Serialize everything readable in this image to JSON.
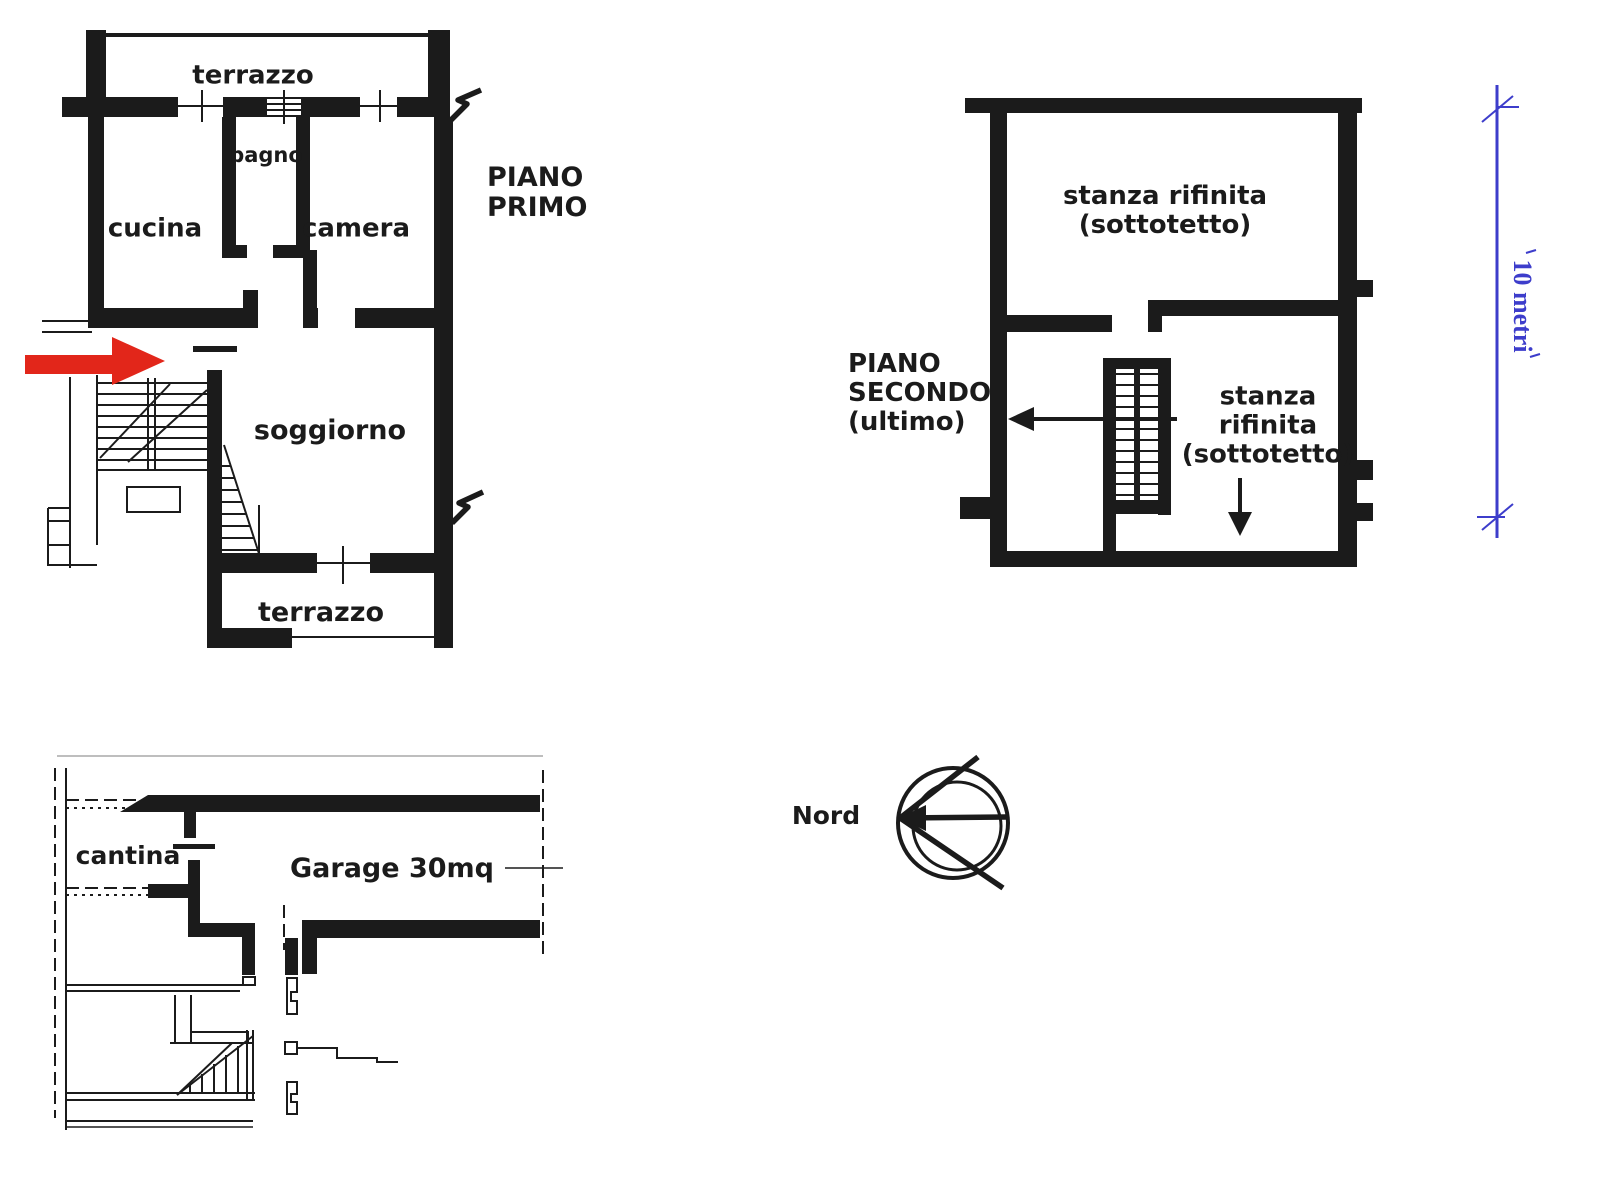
{
  "colors": {
    "ink": "#1b1b1b",
    "arrow_red": "#e2261a",
    "scale_blue": "#3d3dcb",
    "background": "#ffffff"
  },
  "plans": {
    "piano_primo": {
      "title": "PIANO\nPRIMO",
      "rooms": {
        "terrazzo_top": "terrazzo",
        "bagno": "bagno",
        "cucina": "cucina",
        "camera": "camera",
        "soggiorno": "soggiorno",
        "terrazzo_bottom": "terrazzo"
      }
    },
    "piano_secondo": {
      "title": "PIANO\nSECONDO\n(ultimo)",
      "rooms": {
        "stanza_top": "stanza rifinita\n(sottotetto)",
        "stanza_right": "stanza\nrifinita\n(sottotetto)"
      }
    },
    "interrato": {
      "rooms": {
        "cantina": "cantina",
        "garage": "Garage 30mq"
      }
    }
  },
  "scale_bar": {
    "label": "10 metri"
  },
  "compass": {
    "label": "Nord"
  }
}
